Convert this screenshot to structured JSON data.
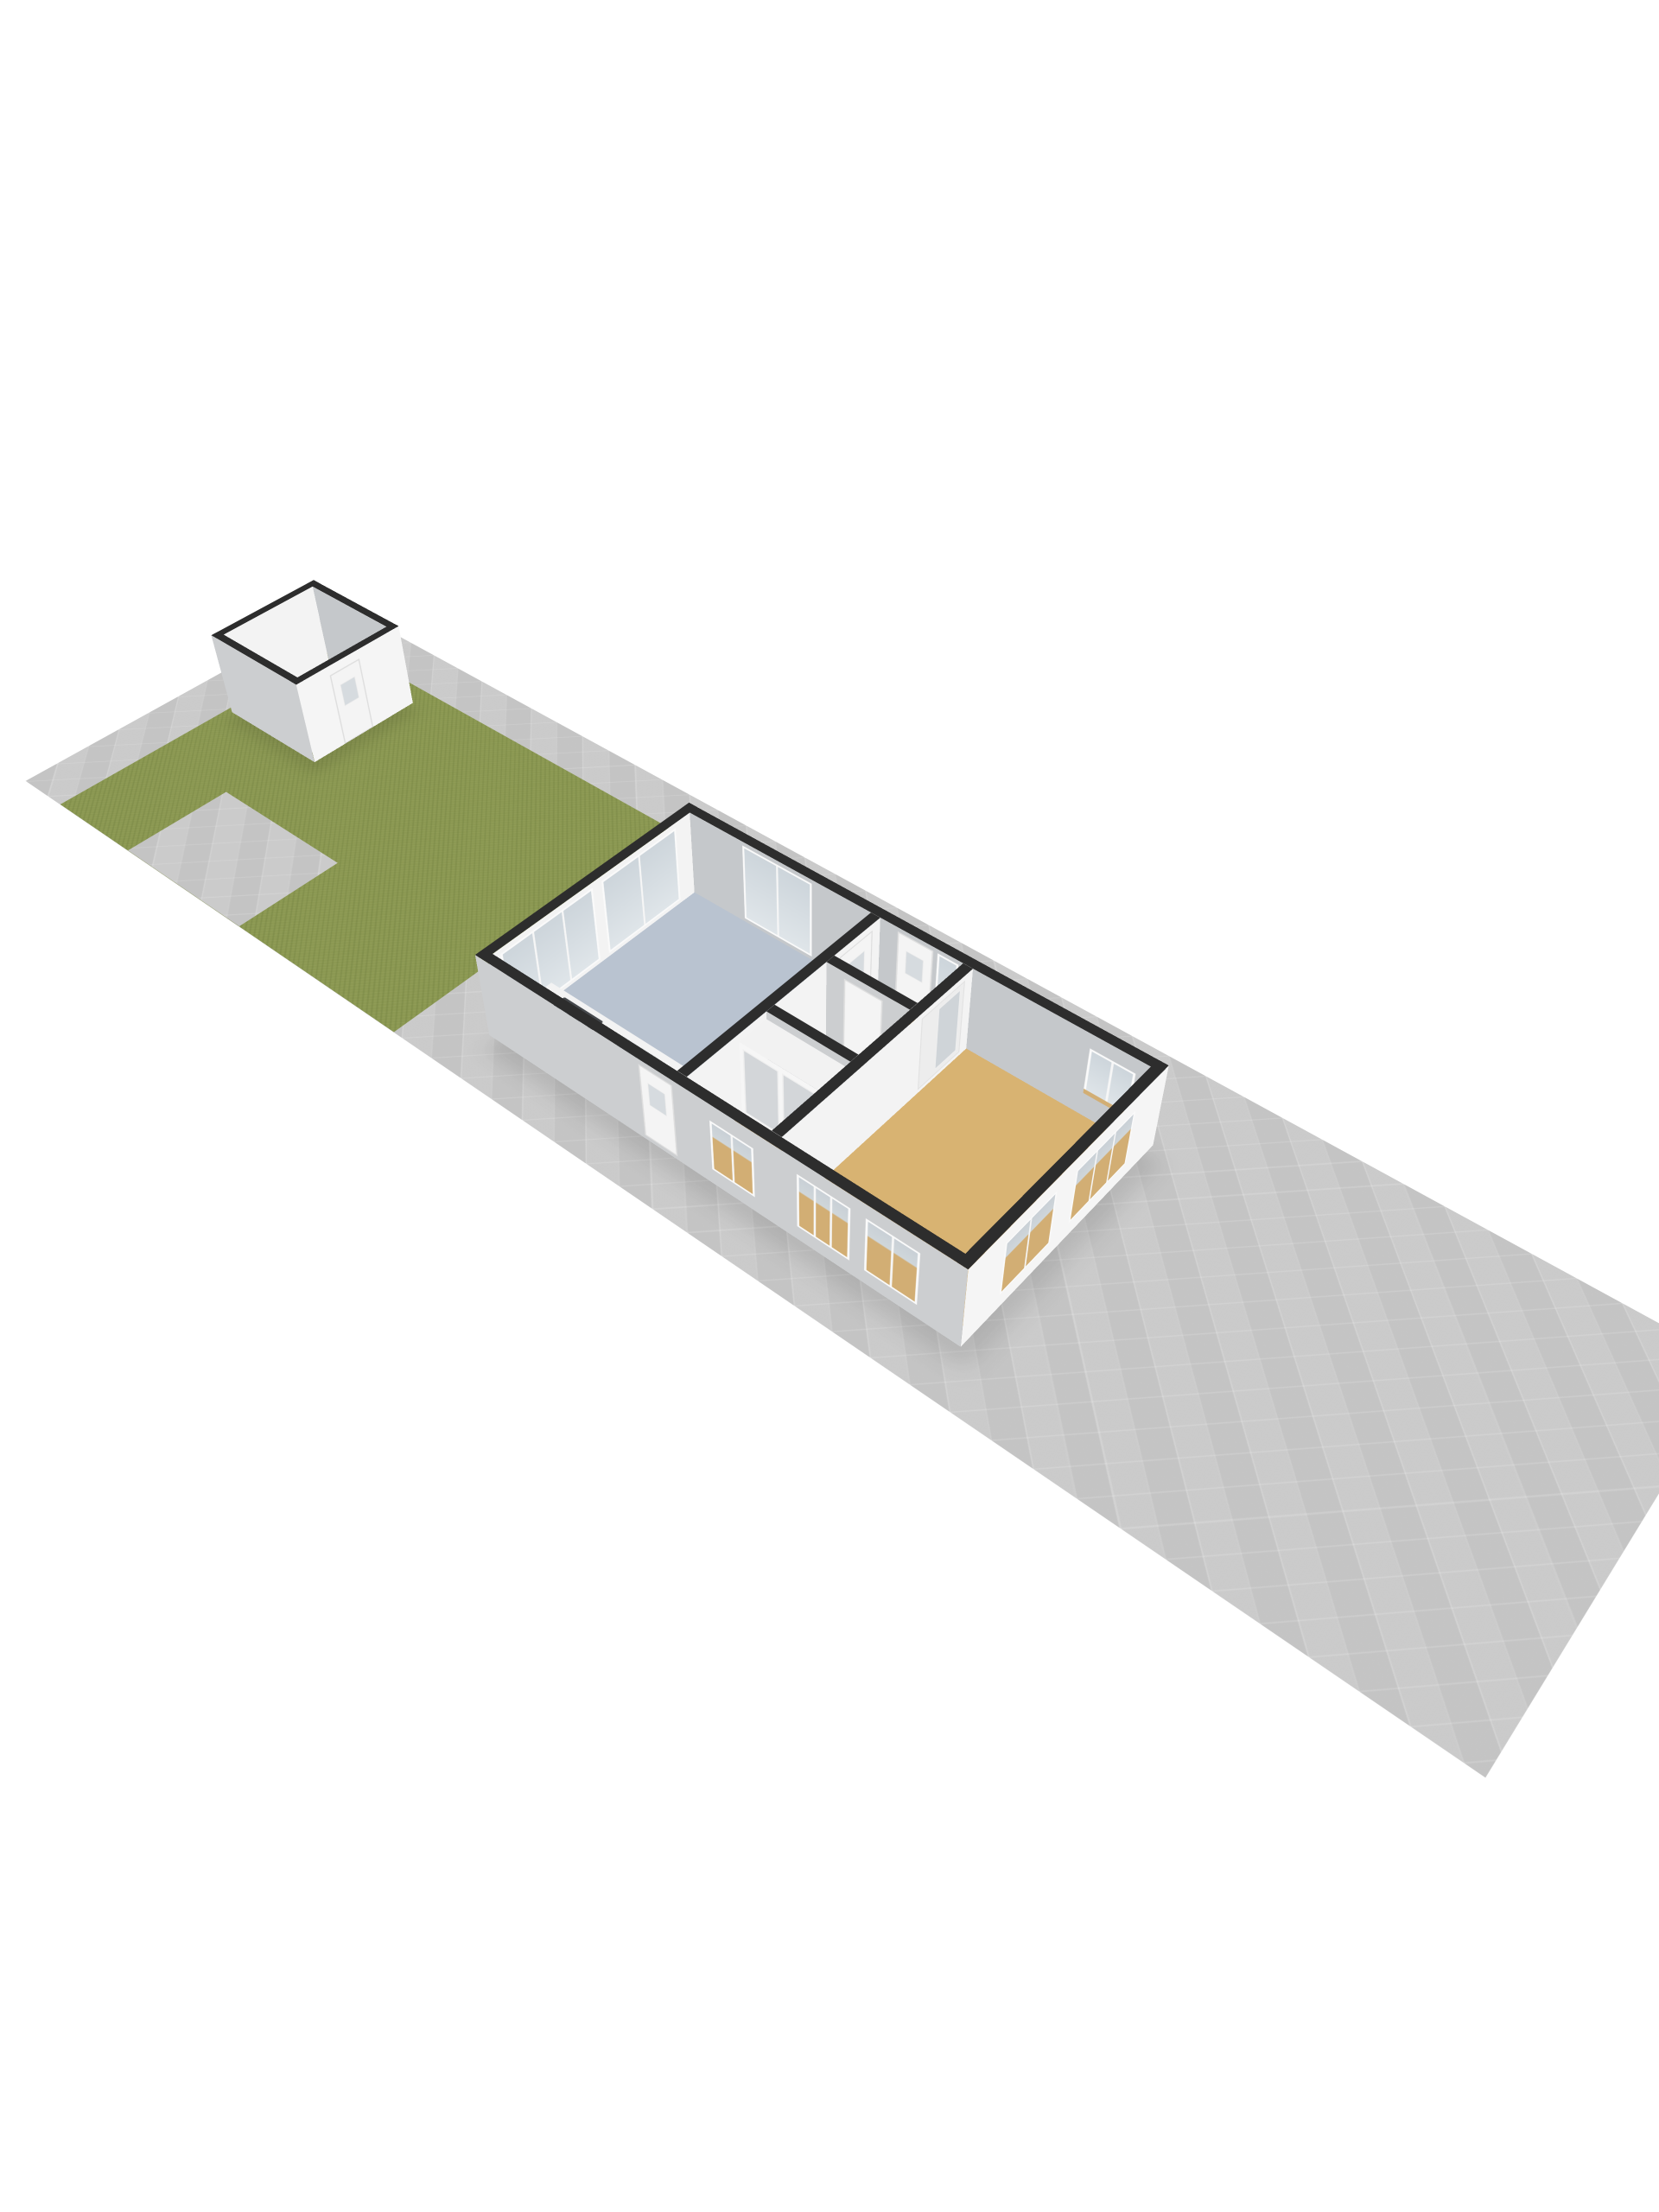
{
  "scene": {
    "kind": "3d-floorplan-isometric-render",
    "background": "#ffffff",
    "camera": "high-angle birds-eye, lot rotated ~40deg, strong depth",
    "text_on_screen": "none"
  },
  "colors": {
    "bg": "#ffffff",
    "pavement": "#c9c9c9",
    "grass": "#8b9852",
    "cap": "#2d2d2d",
    "wall-bright": "#f3f3f3",
    "wall-outer-se": "#f5f5f5",
    "wall-shade": "#ccced0",
    "wall-inner-ne": "#c5c8cb",
    "floor-blue": "#b9c3d0",
    "floor-tan": "#d8b372",
    "floor-gray": "#cfcfcf",
    "floor-shed": "#e7e7e7",
    "sill": "#d2ae74",
    "glass": "#d4dbe0",
    "shadow": "#9a9a9a"
  },
  "lot": {
    "description": "long narrow paved parcel seen in isometric view",
    "surface": "light gray paving with diamond tile pattern",
    "garden": {
      "surface": "grass",
      "position": "northwest end of lot",
      "paved_notch": "rectangular paved patch cut into southwest side of the grass"
    }
  },
  "shed": {
    "description": "small square outbuilding on the grass at the far end",
    "walls": "white with dark top caps",
    "door_wall": "southeast (facing house)",
    "interior": [
      "light gray floor",
      "small white shelf unit near east corner"
    ]
  },
  "house": {
    "walls": "white exterior, dark gray top caps",
    "rooms": [
      {
        "name": "kitchen-living-room",
        "floor_color_key": "floor-blue",
        "fixtures": [
          "kitchen counter along southwest wall",
          "gas cooktop with 4 burners",
          "sink with faucet"
        ],
        "windows": [
          "two sliding windows on northwest wall",
          "double glass door on northeast wall"
        ]
      },
      {
        "name": "entrance-hall",
        "floor_color_key": "floor-tan",
        "fixtures": [
          "front door with sidelight window on northeast wall",
          "interior door to kitchen"
        ]
      },
      {
        "name": "toilet",
        "floor_color_key": "floor-gray",
        "fixtures": [
          "door from hall"
        ]
      },
      {
        "name": "bedroom",
        "floor_color_key": "floor-tan",
        "fixtures": [
          "double closet with gray sliding doors on northeast wall",
          "window on southwest wall"
        ]
      },
      {
        "name": "living-room-large",
        "floor_color_key": "floor-tan",
        "fixtures": [
          "sliding door from hall"
        ],
        "windows": [
          "window on northeast wall near east corner",
          "two windows on southeast wall",
          "two windows on southwest wall"
        ]
      }
    ],
    "exterior_doors": [
      "front door northeast side",
      "back door southwest side"
    ]
  }
}
